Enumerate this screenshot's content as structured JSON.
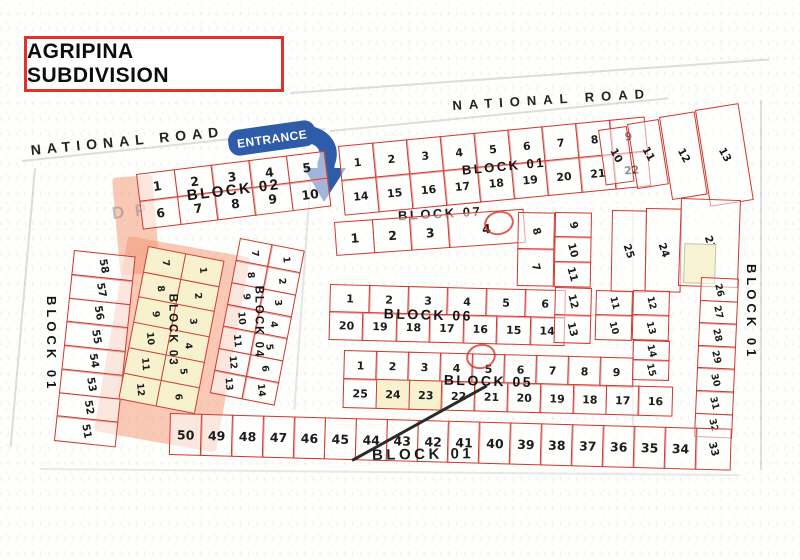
{
  "title": "AGRIPINA SUBDIVISION",
  "roads": {
    "national_road_left": "NATIONAL ROAD",
    "national_road_right": "NATIONAL ROAD"
  },
  "entrance_label": "ENTRANCE",
  "watermark": "D P",
  "colors": {
    "lot_border_red": "#cf372e",
    "entrance_blue": "#2e5ca8",
    "highlight_yellow": "#f7f2cd",
    "highlight_pink": "rgba(243,148,112,0.5)",
    "title_border_red": "#e0312b"
  },
  "blocks": {
    "block01": {
      "label": "BLOCK 01",
      "top_row_a": [
        "1",
        "2",
        "3",
        "4",
        "5",
        "6",
        "7",
        "8",
        "9"
      ],
      "top_row_b": [
        "14",
        "15",
        "16",
        "17",
        "18",
        "19",
        "20",
        "21",
        "22"
      ],
      "top_right_lots": [
        "10",
        "11",
        "12",
        "13"
      ],
      "right_tall_lots": [
        "25",
        "24",
        "23"
      ],
      "right_column": [
        "26",
        "27",
        "28",
        "29",
        "30",
        "31",
        "32"
      ],
      "corner_lot": [
        "33"
      ],
      "bottom_row": [
        "50",
        "49",
        "48",
        "47",
        "46",
        "45",
        "44",
        "43",
        "42",
        "41",
        "40",
        "39",
        "38",
        "37",
        "36",
        "35",
        "34"
      ],
      "left_column": [
        "58",
        "57",
        "56",
        "55",
        "54",
        "53",
        "52",
        "51"
      ]
    },
    "block02": {
      "label": "BLOCK 02",
      "row_a": [
        "1",
        "2",
        "3",
        "4",
        "5"
      ],
      "row_b": [
        "6",
        "7",
        "8",
        "9",
        "10"
      ]
    },
    "block03": {
      "label": "BLOCK 03",
      "left_col": [
        "7",
        "8",
        "9",
        "10",
        "11",
        "12"
      ],
      "right_col": [
        "1",
        "2",
        "3",
        "4",
        "5",
        "6"
      ]
    },
    "block04": {
      "label": "BLOCK 04",
      "left_col": [
        "7",
        "8",
        "9",
        "10",
        "11",
        "12",
        "13"
      ],
      "right_col": [
        "1",
        "2",
        "3",
        "4",
        "5",
        "6",
        "14"
      ]
    },
    "block05": {
      "label": "BLOCK 05",
      "row_a": [
        "1",
        "2",
        "3",
        "4",
        "5",
        "6",
        "7",
        "8",
        "9"
      ],
      "row_b": [
        "25",
        "24",
        "23",
        "22",
        "21",
        "20",
        "19",
        "18",
        "17",
        "16"
      ],
      "highlighted_lots": "24,23",
      "ext_col_a": [
        "11",
        "10"
      ],
      "ext_col_b": [
        "12",
        "13"
      ],
      "ext_col_c": [
        "14",
        "15"
      ]
    },
    "block06": {
      "label": "BLOCK 06",
      "row_a": [
        "1",
        "2",
        "3",
        "4",
        "5",
        "6"
      ],
      "row_b": [
        "20",
        "19",
        "18",
        "17",
        "16",
        "15",
        "14"
      ],
      "ext_col_a": [
        "8",
        "7"
      ],
      "ext_col_b": [
        "9",
        "10",
        "11"
      ],
      "side_col": [
        "12",
        "13"
      ]
    },
    "block07": {
      "label": "BLOCK 07",
      "row": [
        "1",
        "2",
        "3",
        "4"
      ]
    }
  }
}
